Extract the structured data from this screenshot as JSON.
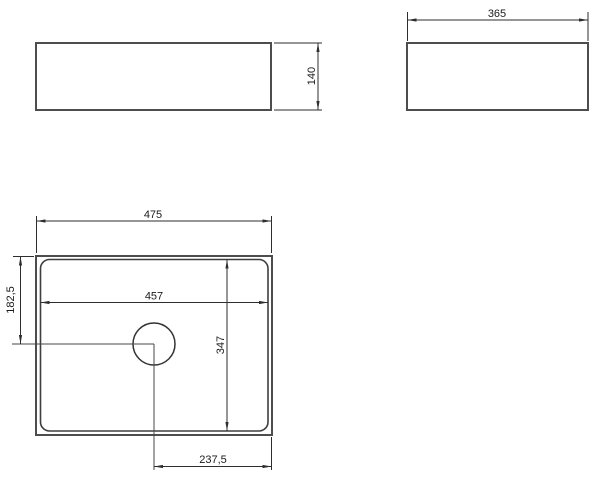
{
  "drawing": {
    "background": "#ffffff",
    "object_line_color": "#4d4d4d",
    "dimension_line_color": "#2e2e2e",
    "text_color": "#1a1a1a",
    "views": {
      "front": {
        "height_dim": "140"
      },
      "side": {
        "width_dim": "365"
      },
      "plan": {
        "outer_width_dim": "475",
        "inner_width_dim": "457",
        "inner_depth_dim": "347",
        "drain_offset_left_dim": "182,5",
        "drain_offset_bottom_dim": "237,5"
      }
    }
  }
}
